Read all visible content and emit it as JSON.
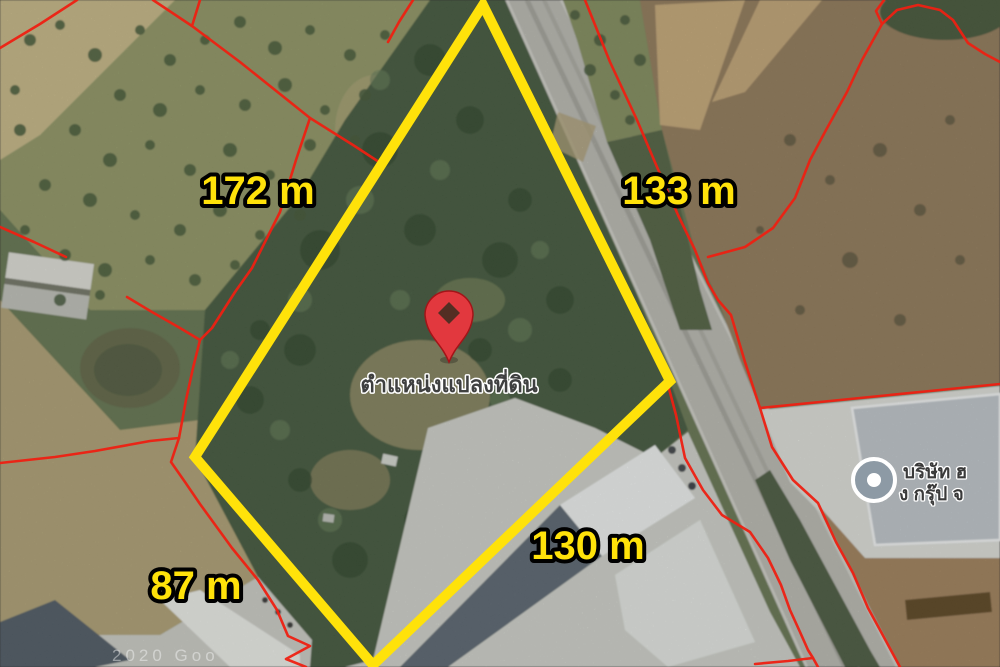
{
  "map": {
    "measurements": {
      "west": "172 m",
      "east": "133 m",
      "south": "130 m",
      "southwest": "87 m"
    },
    "pin_label": "ตำแหน่งแปลงที่ดิน",
    "business": {
      "line1": "บริษัท ฮ",
      "line2": "ง กรุ๊ป จ"
    },
    "watermark": "2020 Goo",
    "colors": {
      "plot_outline": "#ffe20a",
      "parcel_line": "#ee2012",
      "label_text": "#ffe20a",
      "pin": "#e2383e",
      "poi_fill": "#8d9aa5"
    }
  }
}
